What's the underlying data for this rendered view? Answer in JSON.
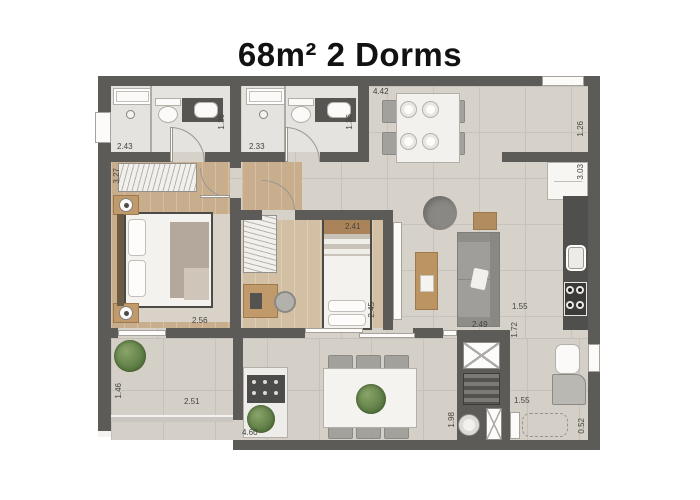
{
  "title": "68m² 2 Dorms",
  "dimensions": {
    "bathroom1_width": "2.43",
    "bathroom1_depth": "1.36",
    "bathroom2_width": "2.33",
    "bathroom2_depth": "1.36",
    "living_top_width": "4.42",
    "entry_recess_depth": "1.26",
    "kitchen_wall_length": "3.03",
    "bedroom1_depth": "3.27",
    "bedroom1_width": "2.56",
    "bedroom2_width": "2.41",
    "bedroom2_depth": "2.45",
    "sofa_wall_length": "2.49",
    "kitchen_passage_width": "1.55",
    "service_depth": "1.72",
    "service_width": "1.55",
    "service_side": "0.52",
    "balcony_depth": "1.46",
    "balcony_width": "2.51",
    "terrace_width": "4.60",
    "terrace_depth": "1.98"
  },
  "colors": {
    "wall": "#5c5b57",
    "floor_tile": "#d6d1c9",
    "wood_floor": "#c9ae8e",
    "counter_dark": "#4f4f4d",
    "plant_green": "#5e7d46",
    "title_text": "#121212"
  }
}
